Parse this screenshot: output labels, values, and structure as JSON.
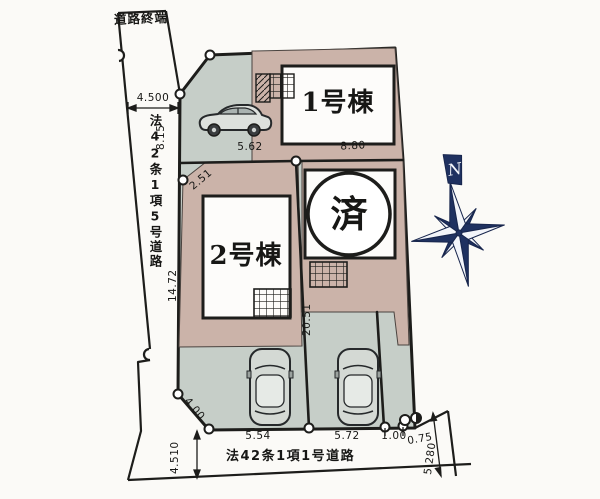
{
  "plan": {
    "roads": {
      "end_label": "道路終端",
      "west_name": "法42条1項5号道路",
      "south_name": "法42条1項1号道路"
    },
    "buildings": {
      "b1": "1号棟",
      "b2": "2号棟",
      "sold": "済"
    },
    "compass": {
      "north": "N"
    },
    "dimensions": {
      "west_road_width": "4.500",
      "west_upper": "8.15",
      "north_width": "5.62",
      "lot1_width": "8.80",
      "cut_upper": "2.51",
      "west_lower": "14.72",
      "center_depth": "20.51",
      "cut_lower": "4.00",
      "lot2_frontage": "5.54",
      "sold_frontage": "5.72",
      "front_a": "1.00",
      "front_b": "0.75",
      "south_left": "4.510",
      "south_right": "5.280"
    },
    "colors": {
      "lot": "#cbb3a9",
      "paving": "#c6cec8",
      "line": "#1d1d1b",
      "compass": "#1f3160",
      "compass_light": "#f3f5fa",
      "paper": "#fbfaf7"
    }
  }
}
